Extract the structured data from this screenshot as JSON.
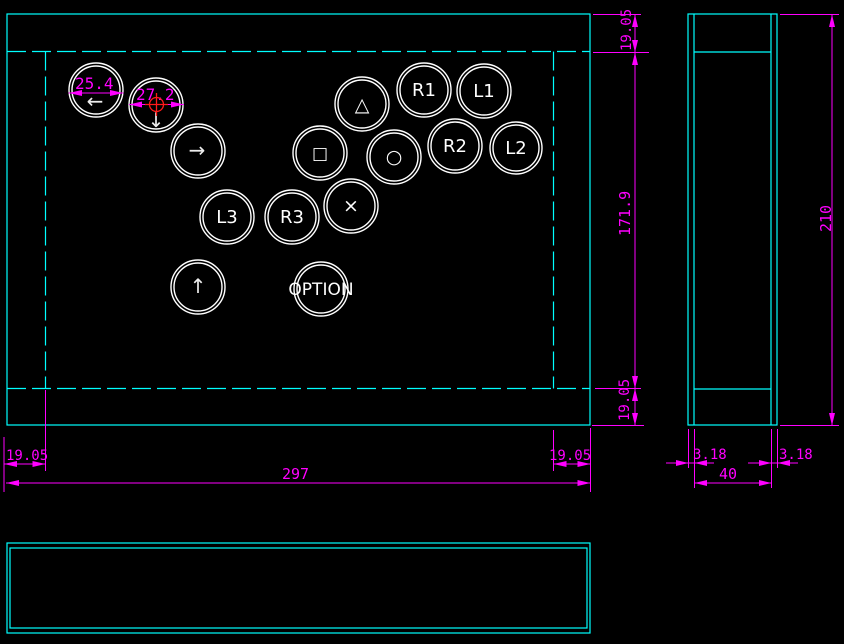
{
  "drawing": {
    "description": "CAD drawing of hitbox-style arcade controller: front view with button layout, side view, and bottom view",
    "colors": {
      "background": "#000000",
      "outline": "#00ffff",
      "dimension": "#ff00ff",
      "center_mark": "#ff1a1a",
      "button_stroke": "#ffffff"
    }
  },
  "buttons": [
    {
      "id": "dpad-left",
      "label": "←"
    },
    {
      "id": "dpad-down",
      "label": "↓"
    },
    {
      "id": "dpad-right",
      "label": "→"
    },
    {
      "id": "btn-triangle",
      "label": "△"
    },
    {
      "id": "btn-r1",
      "label": "R1"
    },
    {
      "id": "btn-l1",
      "label": "L1"
    },
    {
      "id": "btn-square",
      "label": "□"
    },
    {
      "id": "btn-circle",
      "label": "○"
    },
    {
      "id": "btn-r2",
      "label": "R2"
    },
    {
      "id": "btn-l2",
      "label": "L2"
    },
    {
      "id": "btn-cross",
      "label": "×"
    },
    {
      "id": "btn-r3",
      "label": "R3"
    },
    {
      "id": "btn-l3",
      "label": "L3"
    },
    {
      "id": "dpad-up",
      "label": "↑"
    },
    {
      "id": "btn-option",
      "label": "OPTION"
    }
  ],
  "dimensions": {
    "left_button_diameter": "25.4",
    "down_button_diameter": "27.2",
    "front_margin_left": "19.05",
    "front_width": "297",
    "front_margin_right": "19.05",
    "side_margin_top": "19.05",
    "side_height_inner": "171.9",
    "side_margin_bottom": "19.05",
    "side_height_total": "210",
    "side_wall_left": "3.18",
    "side_depth": "40",
    "side_wall_right": "3.18"
  }
}
